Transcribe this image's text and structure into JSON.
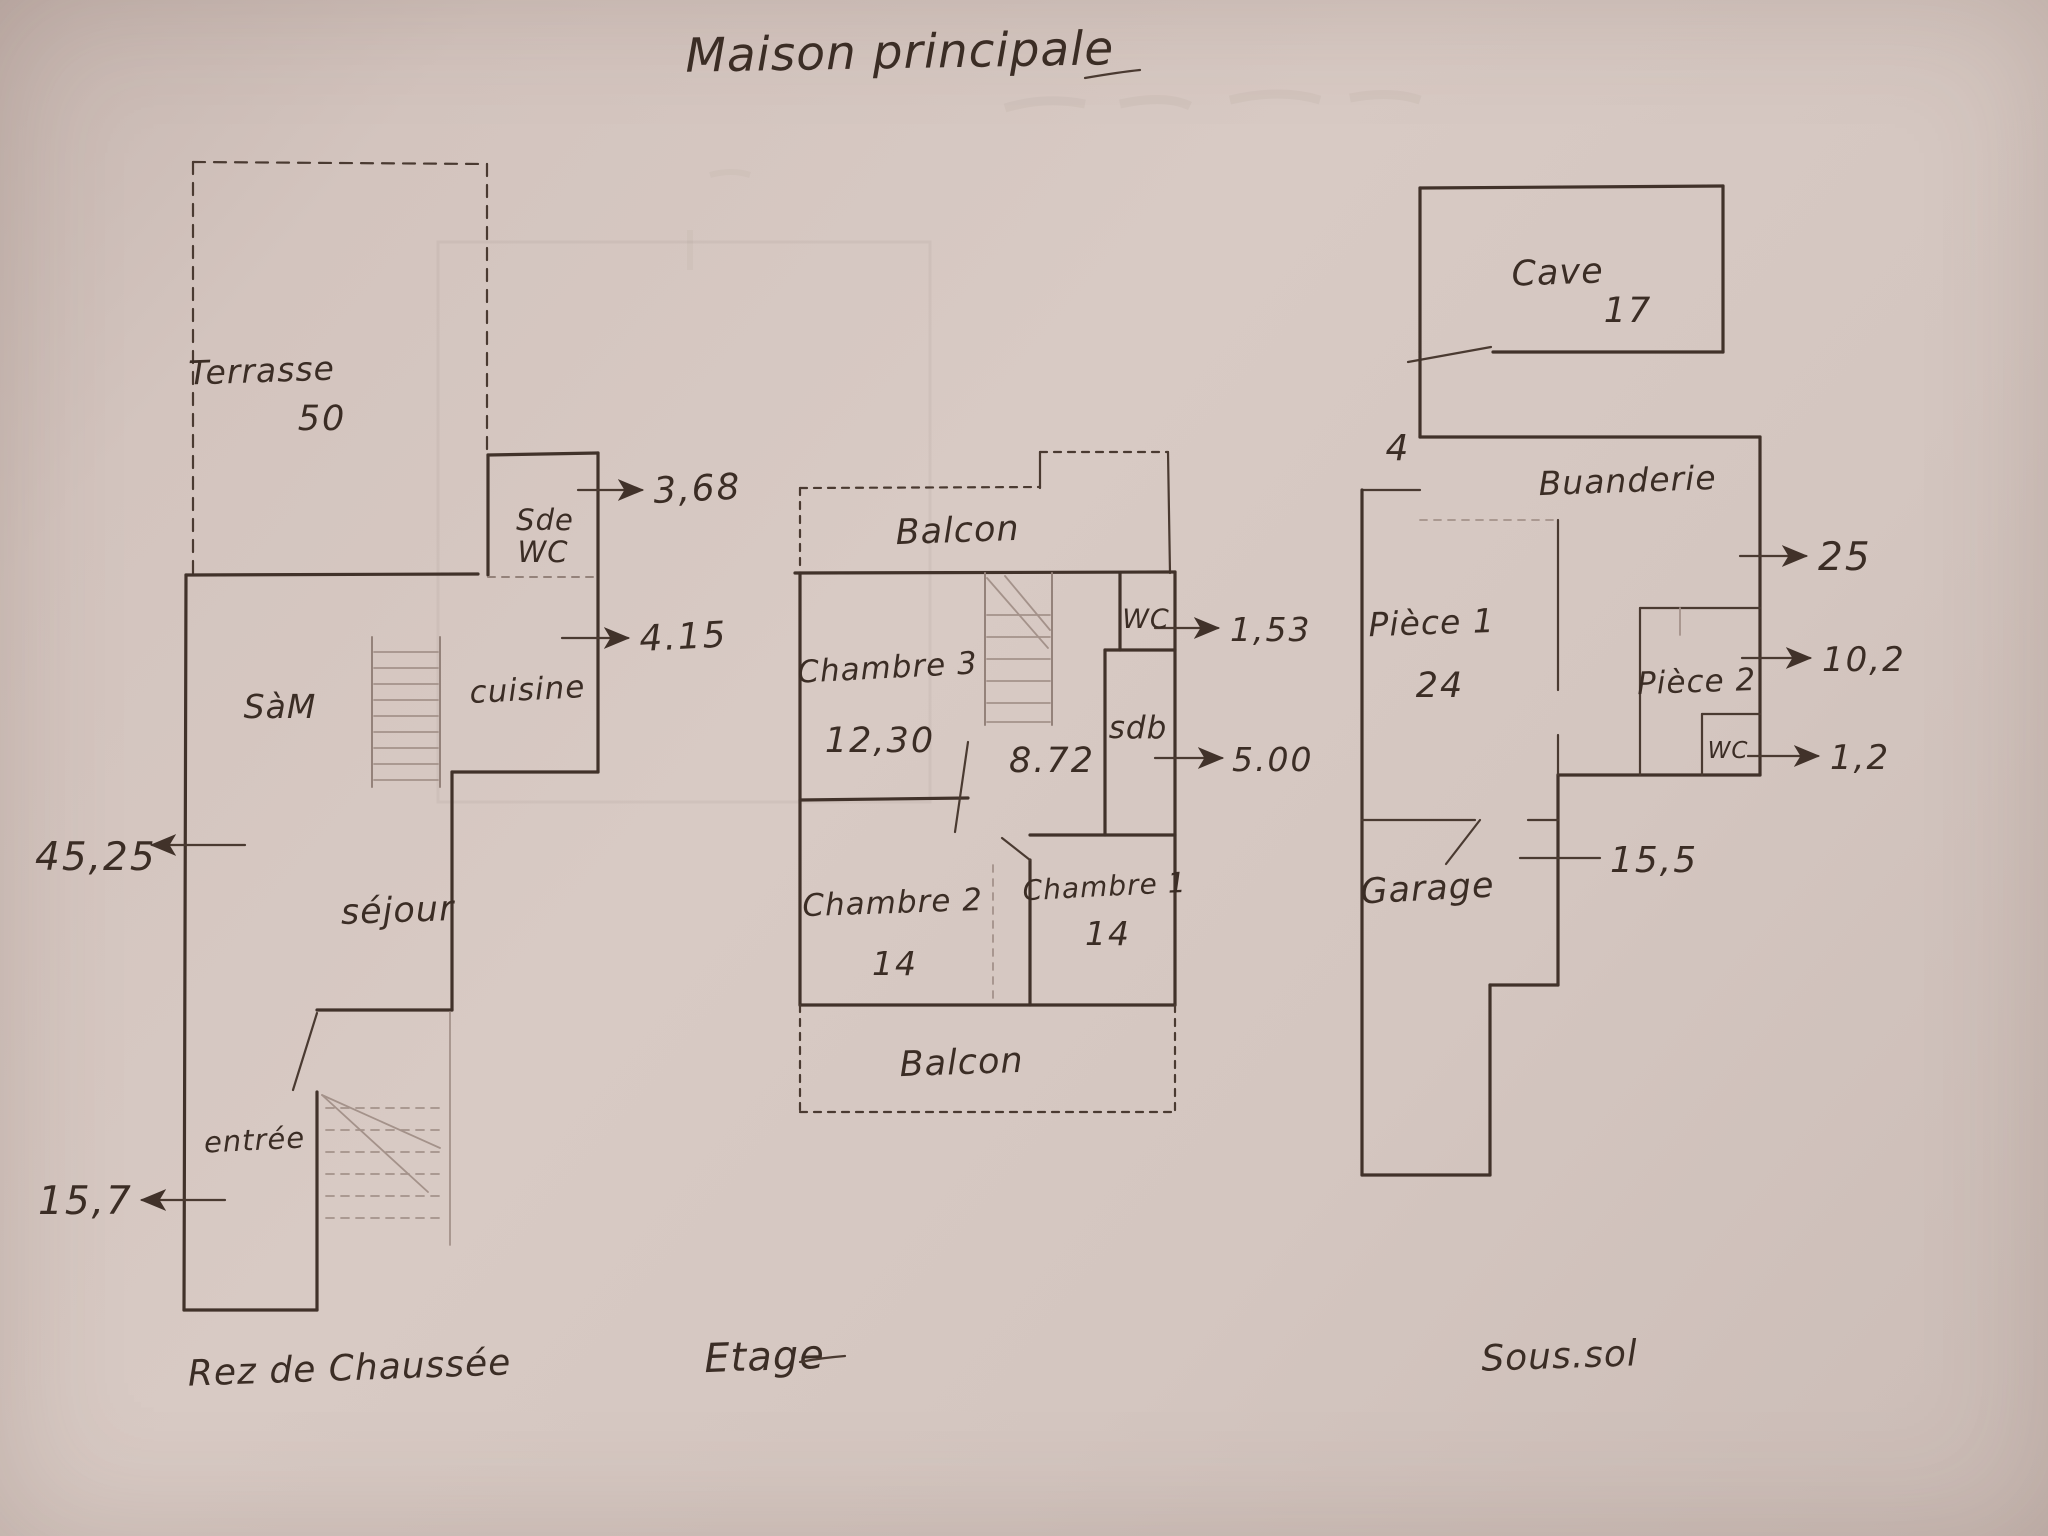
{
  "title": "Maison principale",
  "colors": {
    "paper": "#d5c7c1",
    "ink": "#41322a",
    "pencil": "#94827a"
  },
  "ground_floor": {
    "label": "Rez de Chaussée",
    "terrasse": "Terrasse",
    "terrasse_area": "50",
    "sde": "Sde",
    "sde_wc": "WC",
    "sde_wc_area": "3,68",
    "cuisine": "cuisine",
    "cuisine_area": "4.15",
    "salle_a_manger": "SàM",
    "sejour": "séjour",
    "sejour_area": "45,25",
    "entree": "entrée",
    "entree_area": "15,7"
  },
  "upper_floor": {
    "label": "Etage",
    "balcon_top": "Balcon",
    "balcon_bottom": "Balcon",
    "chambre3": "Chambre 3",
    "chambre3_area": "12,30",
    "palier_area": "8.72",
    "wc": "WC",
    "wc_area": "1,53",
    "sdb": "sdb",
    "sdb_area": "5.00",
    "chambre2": "Chambre 2",
    "chambre2_area": "14",
    "chambre1": "Chambre 1",
    "chambre1_area": "14"
  },
  "basement": {
    "label": "Sous.sol",
    "cave": "Cave",
    "cave_area": "17",
    "escalier_area": "4",
    "buanderie": "Buanderie",
    "buanderie_area": "25",
    "piece1": "Pièce 1",
    "piece1_area": "24",
    "piece2": "Pièce 2",
    "piece2_area": "10,2",
    "wc": "WC",
    "wc_area": "1,2",
    "garage": "Garage",
    "garage_measure": "15,5"
  }
}
